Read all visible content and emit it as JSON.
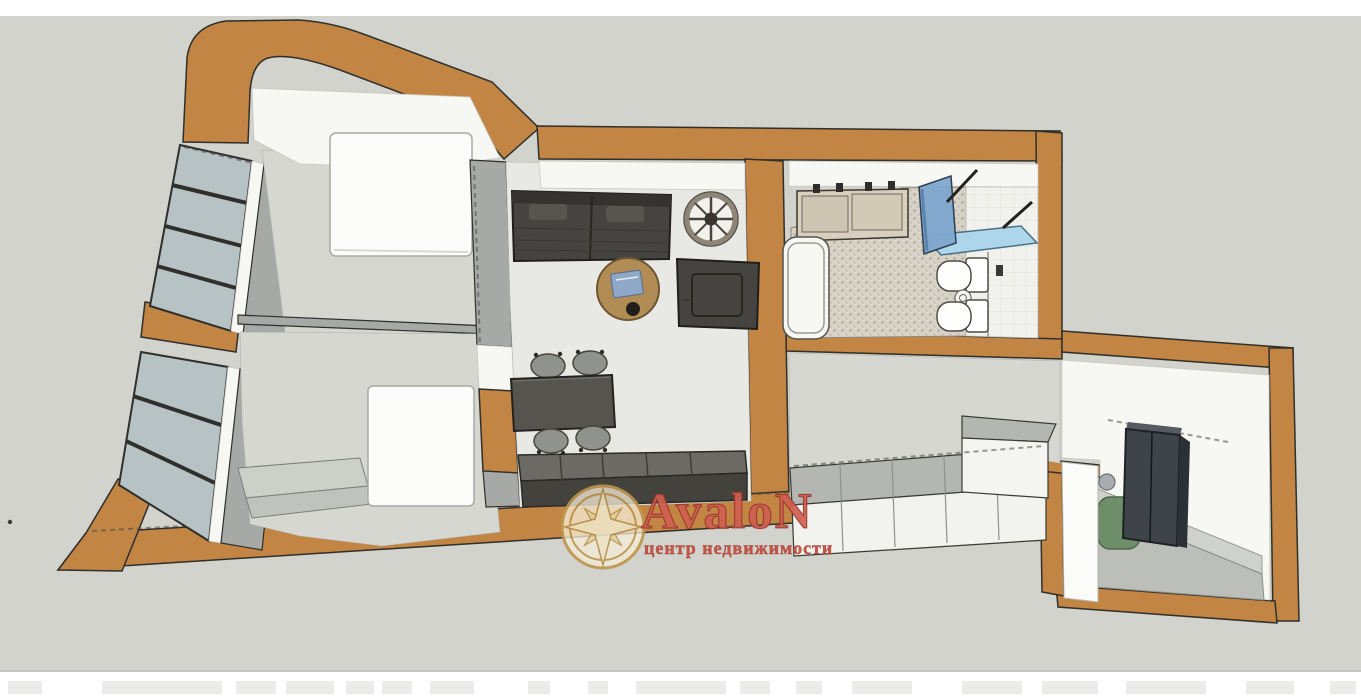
{
  "watermark": {
    "brand": "AvaloN",
    "tagline": "центр недвижимости",
    "logo_icon": "compass-rose-icon",
    "brand_color": "#d0604f",
    "tagline_color": "#c44b3c",
    "logo_gold": "#bf964e",
    "logo_cream": "#f2e9cf"
  },
  "palette": {
    "bg": "#d2d3cc",
    "wall-orange": "#c28544",
    "wall-gray": "#a7a9a6",
    "floor-light": "#e8e9e4",
    "floor-mid": "#d6d7d1",
    "floor-dark": "#bcbeb9",
    "white-face": "#f7f7f4",
    "glass": "#b7c2c4",
    "line": "#2f2f2b",
    "sofa": "#454440",
    "wood": "#b18d55",
    "counter-top": "#6b6a64",
    "counter-front": "#44423d",
    "shower-glass": "#7fa7cf",
    "shower-tray": "#aed6ea",
    "wardrobe-dark": "#3f444a",
    "pouf-green": "#6e8e69"
  },
  "scene": {
    "type": "3d-floor-plan-render"
  }
}
